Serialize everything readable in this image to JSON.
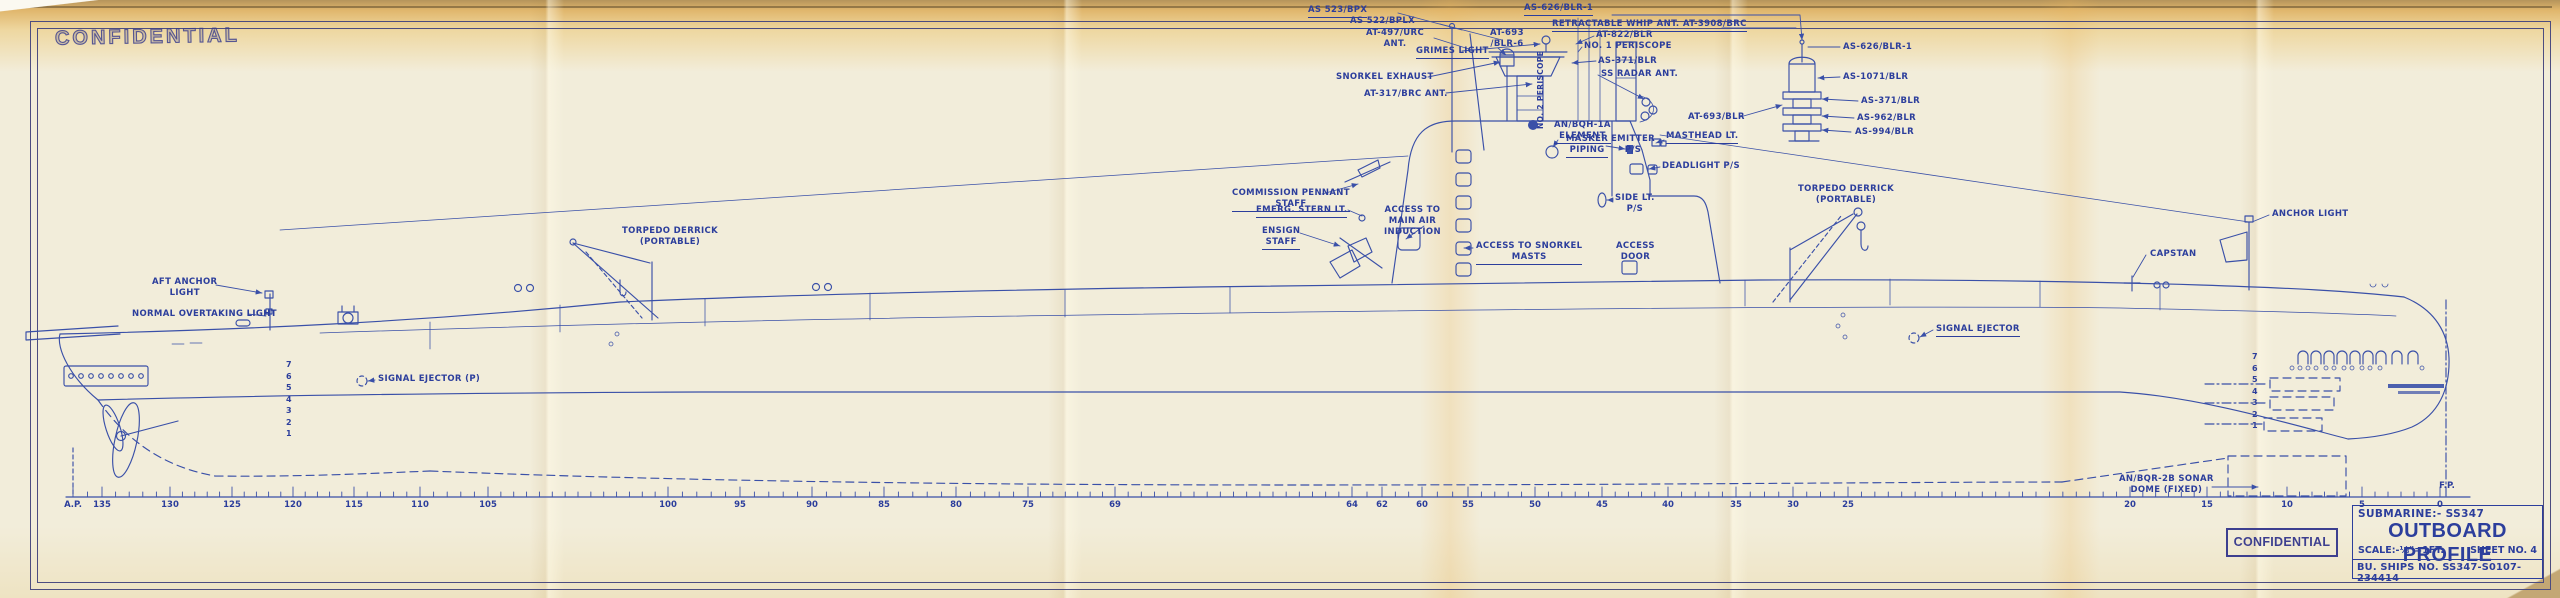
{
  "colors": {
    "ink": "#2c3e9c",
    "line": "#3a50a8",
    "paper": "#f2edda",
    "stamp": "#3d3f8f"
  },
  "stamps": {
    "top_left": "CONFIDENTIAL",
    "boxed": "CONFIDENTIAL"
  },
  "title_block": {
    "submarine": "SUBMARINE:- SS347",
    "title": "OUTBOARD PROFILE",
    "scale": "SCALE:-⅛\"=1FT.",
    "sheet": "SHEET NO. 4",
    "number": "BU. SHIPS NO. SS347-S0107-234414"
  },
  "callouts": [
    {
      "t": "AS 523/BPX",
      "x": 1308,
      "y": 5,
      "ul": true,
      "lead": [
        [
          1398,
          13
        ],
        [
          1462,
          30
        ]
      ]
    },
    {
      "t": "AS 522/BPLX",
      "x": 1350,
      "y": 16,
      "ul": true,
      "lead": [
        [
          1440,
          24
        ],
        [
          1502,
          40
        ]
      ]
    },
    {
      "t": "AT-497/URC\nANT.",
      "x": 1366,
      "y": 28,
      "lead": [
        [
          1434,
          38
        ],
        [
          1472,
          50
        ]
      ]
    },
    {
      "t": "GRIMES LIGHT",
      "x": 1416,
      "y": 46,
      "ul": true,
      "lead": [
        [
          1462,
          51
        ],
        [
          1540,
          44
        ]
      ],
      "arrow": true
    },
    {
      "t": "SNORKEL EXHAUST",
      "x": 1336,
      "y": 72,
      "lead": [
        [
          1428,
          77
        ],
        [
          1500,
          62
        ]
      ],
      "arrow": true
    },
    {
      "t": "AT-317/BRC ANT.",
      "x": 1364,
      "y": 89,
      "lead": [
        [
          1446,
          93
        ],
        [
          1532,
          84
        ]
      ],
      "arrow": true
    },
    {
      "t": "AT-693\n/BLR-6",
      "x": 1490,
      "y": 28,
      "lead": [
        [
          1498,
          48
        ],
        [
          1506,
          55
        ]
      ],
      "arrow": true
    },
    {
      "t": "AS-626/BLR-1",
      "x": 1524,
      "y": 3,
      "ul": true,
      "lead": [
        [
          1612,
          15
        ],
        [
          1800,
          15
        ],
        [
          1802,
          40
        ]
      ],
      "arrow": true
    },
    {
      "t": "RETRACTABLE WHIP ANT. AT-3908/BRC",
      "x": 1552,
      "y": 19,
      "ul": true,
      "lead": [
        [
          1722,
          28
        ],
        [
          1796,
          28
        ]
      ]
    },
    {
      "t": "AT-822/BLR",
      "x": 1596,
      "y": 30,
      "lead": [
        [
          1594,
          36
        ],
        [
          1576,
          44
        ]
      ],
      "arrow": true
    },
    {
      "t": "NO. 1 PERISCOPE",
      "x": 1584,
      "y": 41,
      "lead": [
        [
          1582,
          47
        ],
        [
          1578,
          52
        ]
      ]
    },
    {
      "t": "AS-371/BLR",
      "x": 1598,
      "y": 56,
      "lead": [
        [
          1596,
          61
        ],
        [
          1572,
          63
        ]
      ],
      "arrow": true
    },
    {
      "t": "SS RADAR ANT.",
      "x": 1601,
      "y": 69,
      "lead": [
        [
          1598,
          75
        ],
        [
          1644,
          99
        ]
      ],
      "arrow": true
    },
    {
      "t": "NO. 2 PERISCOPE",
      "x": 1536,
      "y": 129,
      "rot": -90,
      "fs": 7.5
    },
    {
      "t": "AN/BQH-1A\nELEMENT",
      "x": 1554,
      "y": 120,
      "ul": true,
      "lead": [
        [
          1558,
          140
        ],
        [
          1553,
          147
        ]
      ],
      "arrow": true
    },
    {
      "t": "AS-626/BLR-1",
      "x": 1843,
      "y": 42,
      "lead": [
        [
          1840,
          47
        ],
        [
          1808,
          47
        ]
      ]
    },
    {
      "t": "AS-1071/BLR",
      "x": 1843,
      "y": 72,
      "lead": [
        [
          1840,
          77
        ],
        [
          1818,
          78
        ]
      ],
      "arrow": true
    },
    {
      "t": "AS-371/BLR",
      "x": 1861,
      "y": 96,
      "lead": [
        [
          1858,
          101
        ],
        [
          1822,
          99
        ]
      ],
      "arrow": true
    },
    {
      "t": "AS-962/BLR",
      "x": 1857,
      "y": 113,
      "lead": [
        [
          1854,
          118
        ],
        [
          1822,
          116
        ]
      ],
      "arrow": true
    },
    {
      "t": "AS-994/BLR",
      "x": 1855,
      "y": 127,
      "lead": [
        [
          1851,
          132
        ],
        [
          1822,
          130
        ]
      ],
      "arrow": true
    },
    {
      "t": "AT-693/BLR",
      "x": 1688,
      "y": 112,
      "lead": [
        [
          1740,
          117
        ],
        [
          1782,
          105
        ]
      ],
      "arrow": true
    },
    {
      "t": "MASKER\nPIPING",
      "x": 1566,
      "y": 134,
      "ul": true,
      "lead": [
        [
          1606,
          146
        ],
        [
          1625,
          149
        ]
      ],
      "arrow": true
    },
    {
      "t": "EMITTER\nP/S",
      "x": 1611,
      "y": 134
    },
    {
      "t": "MASTHEAD LT.",
      "x": 1666,
      "y": 131,
      "ul": true,
      "lead": [
        [
          1664,
          140
        ],
        [
          1656,
          143
        ]
      ],
      "arrow": true
    },
    {
      "t": "DEADLIGHT P/S",
      "x": 1662,
      "y": 161,
      "lead": [
        [
          1660,
          167
        ],
        [
          1649,
          169
        ]
      ],
      "arrow": true
    },
    {
      "t": "SIDE LT.\nP/S",
      "x": 1615,
      "y": 193,
      "lead": [
        [
          1613,
          200
        ],
        [
          1607,
          200
        ]
      ],
      "arrow": true
    },
    {
      "t": "ACCESS TO\nMAIN AIR\nINDUCTION",
      "x": 1384,
      "y": 205,
      "lead": [
        [
          1424,
          226
        ],
        [
          1406,
          239
        ]
      ],
      "arrow": true
    },
    {
      "t": "ACCESS TO SNORKEL\nMASTS",
      "x": 1476,
      "y": 241,
      "ul": true,
      "lead": [
        [
          1473,
          248
        ],
        [
          1464,
          248
        ]
      ],
      "arrow": true
    },
    {
      "t": "ACCESS\nDOOR",
      "x": 1616,
      "y": 241
    },
    {
      "t": "COMMISSION PENNANT\nSTAFF",
      "x": 1232,
      "y": 188,
      "ul": true,
      "lead": [
        [
          1322,
          194
        ],
        [
          1358,
          184
        ]
      ],
      "arrow": true
    },
    {
      "t": "EMERG. STERN LT.",
      "x": 1256,
      "y": 205,
      "ul": true,
      "lead": [
        [
          1348,
          210
        ],
        [
          1362,
          216
        ]
      ]
    },
    {
      "t": "ENSIGN\nSTAFF",
      "x": 1262,
      "y": 226,
      "ul": true,
      "lead": [
        [
          1300,
          233
        ],
        [
          1340,
          246
        ]
      ],
      "arrow": true
    },
    {
      "t": "AFT ANCHOR\nLIGHT",
      "x": 152,
      "y": 277,
      "lead": [
        [
          216,
          285
        ],
        [
          262,
          293
        ]
      ],
      "arrow": true
    },
    {
      "t": "NORMAL OVERTAKING LIGHT",
      "x": 132,
      "y": 309,
      "lead": [
        [
          248,
          314
        ],
        [
          266,
          316
        ]
      ]
    },
    {
      "t": "TORPEDO DERRICK\n(PORTABLE)",
      "x": 622,
      "y": 226
    },
    {
      "t": "SIGNAL EJECTOR (P)",
      "x": 378,
      "y": 374,
      "lead": [
        [
          375,
          380
        ],
        [
          368,
          381
        ]
      ],
      "arrow": true
    },
    {
      "t": "TORPEDO DERRICK\n(PORTABLE)",
      "x": 1798,
      "y": 184
    },
    {
      "t": "SIGNAL EJECTOR",
      "x": 1936,
      "y": 324,
      "ul": true,
      "lead": [
        [
          1933,
          330
        ],
        [
          1920,
          337
        ]
      ],
      "arrow": true
    },
    {
      "t": "CAPSTAN",
      "x": 2150,
      "y": 249,
      "lead": [
        [
          2146,
          255
        ],
        [
          2133,
          277
        ]
      ]
    },
    {
      "t": "ANCHOR LIGHT",
      "x": 2272,
      "y": 209,
      "lead": [
        [
          2269,
          215
        ],
        [
          2252,
          222
        ]
      ]
    },
    {
      "t": "AN/BQR-2B SONAR\nDOME (FIXED)",
      "x": 2119,
      "y": 474,
      "lead": [
        [
          2212,
          487
        ],
        [
          2258,
          487
        ]
      ],
      "arrow": true
    }
  ],
  "ruler": {
    "stations": [
      {
        "t": "A.P.",
        "x": 73
      },
      {
        "t": "135",
        "x": 102
      },
      {
        "t": "130",
        "x": 170
      },
      {
        "t": "125",
        "x": 232
      },
      {
        "t": "120",
        "x": 293
      },
      {
        "t": "115",
        "x": 354
      },
      {
        "t": "110",
        "x": 420
      },
      {
        "t": "105",
        "x": 488
      },
      {
        "t": "100",
        "x": 668
      },
      {
        "t": "95",
        "x": 740
      },
      {
        "t": "90",
        "x": 812
      },
      {
        "t": "85",
        "x": 884
      },
      {
        "t": "80",
        "x": 956
      },
      {
        "t": "75",
        "x": 1028
      },
      {
        "t": "69",
        "x": 1115
      },
      {
        "t": "64",
        "x": 1352
      },
      {
        "t": "62",
        "x": 1382
      },
      {
        "t": "60",
        "x": 1422
      },
      {
        "t": "55",
        "x": 1468
      },
      {
        "t": "50",
        "x": 1535
      },
      {
        "t": "45",
        "x": 1602
      },
      {
        "t": "40",
        "x": 1668
      },
      {
        "t": "35",
        "x": 1736
      },
      {
        "t": "30",
        "x": 1793
      },
      {
        "t": "25",
        "x": 1848
      },
      {
        "t": "20",
        "x": 2130
      },
      {
        "t": "15",
        "x": 2207
      },
      {
        "t": "10",
        "x": 2287
      },
      {
        "t": "5",
        "x": 2362
      },
      {
        "t": "0",
        "x": 2440
      },
      {
        "t": "F.P.",
        "x": 2447,
        "fp": true
      }
    ]
  },
  "draft_marks": [
    {
      "x": 286,
      "y": 360,
      "step": 11.5,
      "digits": [
        "7",
        "6",
        "5",
        "4",
        "3",
        "2",
        "1"
      ]
    },
    {
      "x": 2252,
      "y": 352,
      "step": 11.5,
      "digits": [
        "7",
        "6",
        "5",
        "4",
        "3",
        "2",
        "1"
      ]
    }
  ]
}
